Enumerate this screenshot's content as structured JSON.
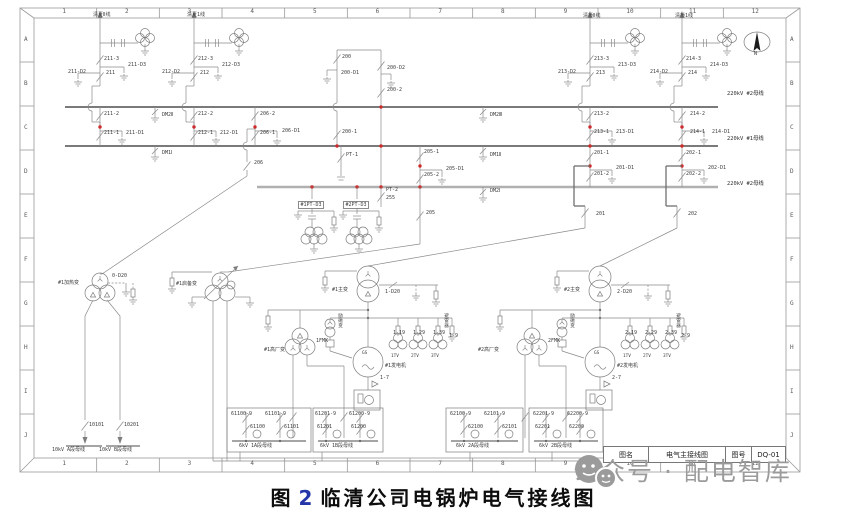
{
  "frame": {
    "columns": [
      "1",
      "2",
      "3",
      "4",
      "5",
      "6",
      "7",
      "8",
      "9",
      "10",
      "11",
      "12"
    ],
    "rows": [
      "A",
      "B",
      "C",
      "D",
      "E",
      "F",
      "G",
      "H",
      "I",
      "J"
    ]
  },
  "title_block": {
    "name_label": "图名",
    "drawing_name": "电气主接线图",
    "no_label": "图号",
    "drawing_no": "DQ-01"
  },
  "caption": {
    "fig_label": "图",
    "fig_no": "2",
    "title": "临清公司电锅炉电气接线图"
  },
  "watermark": {
    "text": "公众号 · 配电智库"
  },
  "colors": {
    "line": "#8a8a8a",
    "bus": "#4f4f4f",
    "transfer_bus": "#b0b0b0",
    "junction_red": "#cc2b2b",
    "caption_number": "#2436a8",
    "watermark": "#9b9b9b"
  },
  "diagram": {
    "labels": [
      {
        "t": "清夏Ⅱ线",
        "x": 93,
        "y": 13
      },
      {
        "t": "清夏1线",
        "x": 187,
        "y": 13
      },
      {
        "t": "清桥Ⅱ线",
        "x": 583,
        "y": 14
      },
      {
        "t": "清桥1线",
        "x": 675,
        "y": 14
      },
      {
        "t": "211-3",
        "x": 104,
        "y": 57
      },
      {
        "t": "211-D3",
        "x": 128,
        "y": 63
      },
      {
        "t": "211-D2",
        "x": 68,
        "y": 70
      },
      {
        "t": "211",
        "x": 106,
        "y": 71
      },
      {
        "t": "211-2",
        "x": 104,
        "y": 112
      },
      {
        "t": "211-1",
        "x": 104,
        "y": 131
      },
      {
        "t": "211-D1",
        "x": 126,
        "y": 131
      },
      {
        "t": "212-3",
        "x": 198,
        "y": 57
      },
      {
        "t": "212-D3",
        "x": 222,
        "y": 63
      },
      {
        "t": "212-D2",
        "x": 162,
        "y": 70
      },
      {
        "t": "212",
        "x": 200,
        "y": 71
      },
      {
        "t": "212-2",
        "x": 198,
        "y": 112
      },
      {
        "t": "212-1",
        "x": 198,
        "y": 131
      },
      {
        "t": "212-D1",
        "x": 220,
        "y": 131
      },
      {
        "t": "206-2",
        "x": 260,
        "y": 112
      },
      {
        "t": "206-1",
        "x": 260,
        "y": 131
      },
      {
        "t": "206-D1",
        "x": 282,
        "y": 129
      },
      {
        "t": "206",
        "x": 254,
        "y": 161
      },
      {
        "t": "DM2Ⅱ",
        "x": 162,
        "y": 113
      },
      {
        "t": "DM1Ⅰ",
        "x": 162,
        "y": 151
      },
      {
        "t": "200",
        "x": 342,
        "y": 55
      },
      {
        "t": "200-D1",
        "x": 341,
        "y": 71
      },
      {
        "t": "200-D2",
        "x": 387,
        "y": 66
      },
      {
        "t": "200-2",
        "x": 387,
        "y": 88
      },
      {
        "t": "200-1",
        "x": 342,
        "y": 130
      },
      {
        "t": "DM2Ⅲ",
        "x": 490,
        "y": 113
      },
      {
        "t": "DM1Ⅱ",
        "x": 490,
        "y": 153
      },
      {
        "t": "DM2Ⅰ",
        "x": 490,
        "y": 189
      },
      {
        "t": "PT-1",
        "x": 346,
        "y": 153
      },
      {
        "t": "PT-2",
        "x": 386,
        "y": 188
      },
      {
        "t": "255",
        "x": 386,
        "y": 196
      },
      {
        "t": "205-1",
        "x": 424,
        "y": 150
      },
      {
        "t": "205-2",
        "x": 424,
        "y": 173
      },
      {
        "t": "205-D1",
        "x": 446,
        "y": 167
      },
      {
        "t": "205",
        "x": 426,
        "y": 211
      },
      {
        "t": "#1PT-D3",
        "x": 298,
        "y": 201,
        "c": "box"
      },
      {
        "t": "#2PT-D3",
        "x": 343,
        "y": 201,
        "c": "box"
      },
      {
        "t": "213-3",
        "x": 594,
        "y": 57
      },
      {
        "t": "213-D3",
        "x": 618,
        "y": 63
      },
      {
        "t": "213-D2",
        "x": 558,
        "y": 70
      },
      {
        "t": "213",
        "x": 596,
        "y": 71
      },
      {
        "t": "213-2",
        "x": 594,
        "y": 112
      },
      {
        "t": "213-1",
        "x": 594,
        "y": 130
      },
      {
        "t": "213-D1",
        "x": 616,
        "y": 130
      },
      {
        "t": "214-3",
        "x": 686,
        "y": 57
      },
      {
        "t": "214-D3",
        "x": 710,
        "y": 63
      },
      {
        "t": "214-D2",
        "x": 650,
        "y": 70
      },
      {
        "t": "214",
        "x": 688,
        "y": 71
      },
      {
        "t": "214-2",
        "x": 690,
        "y": 112
      },
      {
        "t": "214-1",
        "x": 690,
        "y": 130
      },
      {
        "t": "214-D1",
        "x": 712,
        "y": 130
      },
      {
        "t": "201-1",
        "x": 594,
        "y": 151
      },
      {
        "t": "201-2",
        "x": 594,
        "y": 172
      },
      {
        "t": "201-D1",
        "x": 616,
        "y": 166
      },
      {
        "t": "201",
        "x": 596,
        "y": 212
      },
      {
        "t": "202-1",
        "x": 686,
        "y": 151
      },
      {
        "t": "202-2",
        "x": 686,
        "y": 172
      },
      {
        "t": "202-D1",
        "x": 708,
        "y": 166
      },
      {
        "t": "202",
        "x": 688,
        "y": 212
      },
      {
        "t": "220kV #2母线",
        "x": 727,
        "y": 92,
        "c": "bus"
      },
      {
        "t": "220kV #1母线",
        "x": 727,
        "y": 137,
        "c": "bus"
      },
      {
        "t": "220kV #2母线",
        "x": 727,
        "y": 182,
        "c": "bus"
      },
      {
        "t": "#1加热变",
        "x": 58,
        "y": 281
      },
      {
        "t": "0-D20",
        "x": 112,
        "y": 274
      },
      {
        "t": "#1启备变",
        "x": 176,
        "y": 282
      },
      {
        "t": "#1主变",
        "x": 332,
        "y": 288
      },
      {
        "t": "1-D20",
        "x": 385,
        "y": 290
      },
      {
        "t": "#2主变",
        "x": 564,
        "y": 288
      },
      {
        "t": "2-D20",
        "x": 617,
        "y": 290
      },
      {
        "t": "#1高厂变",
        "x": 264,
        "y": 348
      },
      {
        "t": "#2高厂变",
        "x": 478,
        "y": 348
      },
      {
        "t": "1FMK",
        "x": 316,
        "y": 339
      },
      {
        "t": "2FMK",
        "x": 548,
        "y": 339
      },
      {
        "t": "GS",
        "x": 362,
        "y": 352,
        "c": "sm"
      },
      {
        "t": "GS",
        "x": 594,
        "y": 352,
        "c": "sm"
      },
      {
        "t": "#1发电机",
        "x": 385,
        "y": 364
      },
      {
        "t": "#2发电机",
        "x": 617,
        "y": 364
      },
      {
        "t": "1-19",
        "x": 393,
        "y": 331
      },
      {
        "t": "1-29",
        "x": 413,
        "y": 331
      },
      {
        "t": "1-39",
        "x": 433,
        "y": 331
      },
      {
        "t": "1-9",
        "x": 449,
        "y": 334
      },
      {
        "t": "2-19",
        "x": 625,
        "y": 331
      },
      {
        "t": "2-29",
        "x": 645,
        "y": 331
      },
      {
        "t": "2-39",
        "x": 665,
        "y": 331
      },
      {
        "t": "2-9",
        "x": 681,
        "y": 334
      },
      {
        "t": "1TV",
        "x": 391,
        "y": 355,
        "c": "sm"
      },
      {
        "t": "2TV",
        "x": 411,
        "y": 355,
        "c": "sm"
      },
      {
        "t": "3TV",
        "x": 431,
        "y": 355,
        "c": "sm"
      },
      {
        "t": "1TV",
        "x": 623,
        "y": 355,
        "c": "sm"
      },
      {
        "t": "2TV",
        "x": 643,
        "y": 355,
        "c": "sm"
      },
      {
        "t": "3TV",
        "x": 663,
        "y": 355,
        "c": "sm"
      },
      {
        "t": "1-7",
        "x": 380,
        "y": 376
      },
      {
        "t": "2-7",
        "x": 612,
        "y": 376
      },
      {
        "t": "10101",
        "x": 89,
        "y": 423
      },
      {
        "t": "10201",
        "x": 124,
        "y": 423
      },
      {
        "t": "10kV A段母线",
        "x": 52,
        "y": 448
      },
      {
        "t": "10kV B段母线",
        "x": 99,
        "y": 448
      },
      {
        "t": "61100-9",
        "x": 231,
        "y": 412
      },
      {
        "t": "61101-9",
        "x": 265,
        "y": 412
      },
      {
        "t": "61100",
        "x": 250,
        "y": 425
      },
      {
        "t": "61101",
        "x": 284,
        "y": 425
      },
      {
        "t": "6kV 1A段母线",
        "x": 239,
        "y": 444
      },
      {
        "t": "61201-9",
        "x": 315,
        "y": 412
      },
      {
        "t": "61200-9",
        "x": 349,
        "y": 412
      },
      {
        "t": "61201",
        "x": 317,
        "y": 425
      },
      {
        "t": "61200",
        "x": 351,
        "y": 425
      },
      {
        "t": "6kV 1B段母线",
        "x": 320,
        "y": 444
      },
      {
        "t": "62100-9",
        "x": 450,
        "y": 412
      },
      {
        "t": "62101-9",
        "x": 484,
        "y": 412
      },
      {
        "t": "62100",
        "x": 468,
        "y": 425
      },
      {
        "t": "62101",
        "x": 502,
        "y": 425
      },
      {
        "t": "6kV 2A段母线",
        "x": 456,
        "y": 444
      },
      {
        "t": "62201-9",
        "x": 533,
        "y": 412
      },
      {
        "t": "62200-9",
        "x": 567,
        "y": 412
      },
      {
        "t": "62201",
        "x": 535,
        "y": 425
      },
      {
        "t": "62200",
        "x": 569,
        "y": 425
      },
      {
        "t": "6kV 2B段母线",
        "x": 539,
        "y": 444
      },
      {
        "t": "N",
        "x": 754,
        "y": 52
      },
      {
        "t": "励磁变",
        "x": 337,
        "y": 313,
        "c": "v"
      },
      {
        "t": "励磁变",
        "x": 569,
        "y": 313,
        "c": "v"
      },
      {
        "t": "避雷器",
        "x": 443,
        "y": 313,
        "c": "v"
      },
      {
        "t": "避雷器",
        "x": 675,
        "y": 313,
        "c": "v"
      }
    ]
  }
}
